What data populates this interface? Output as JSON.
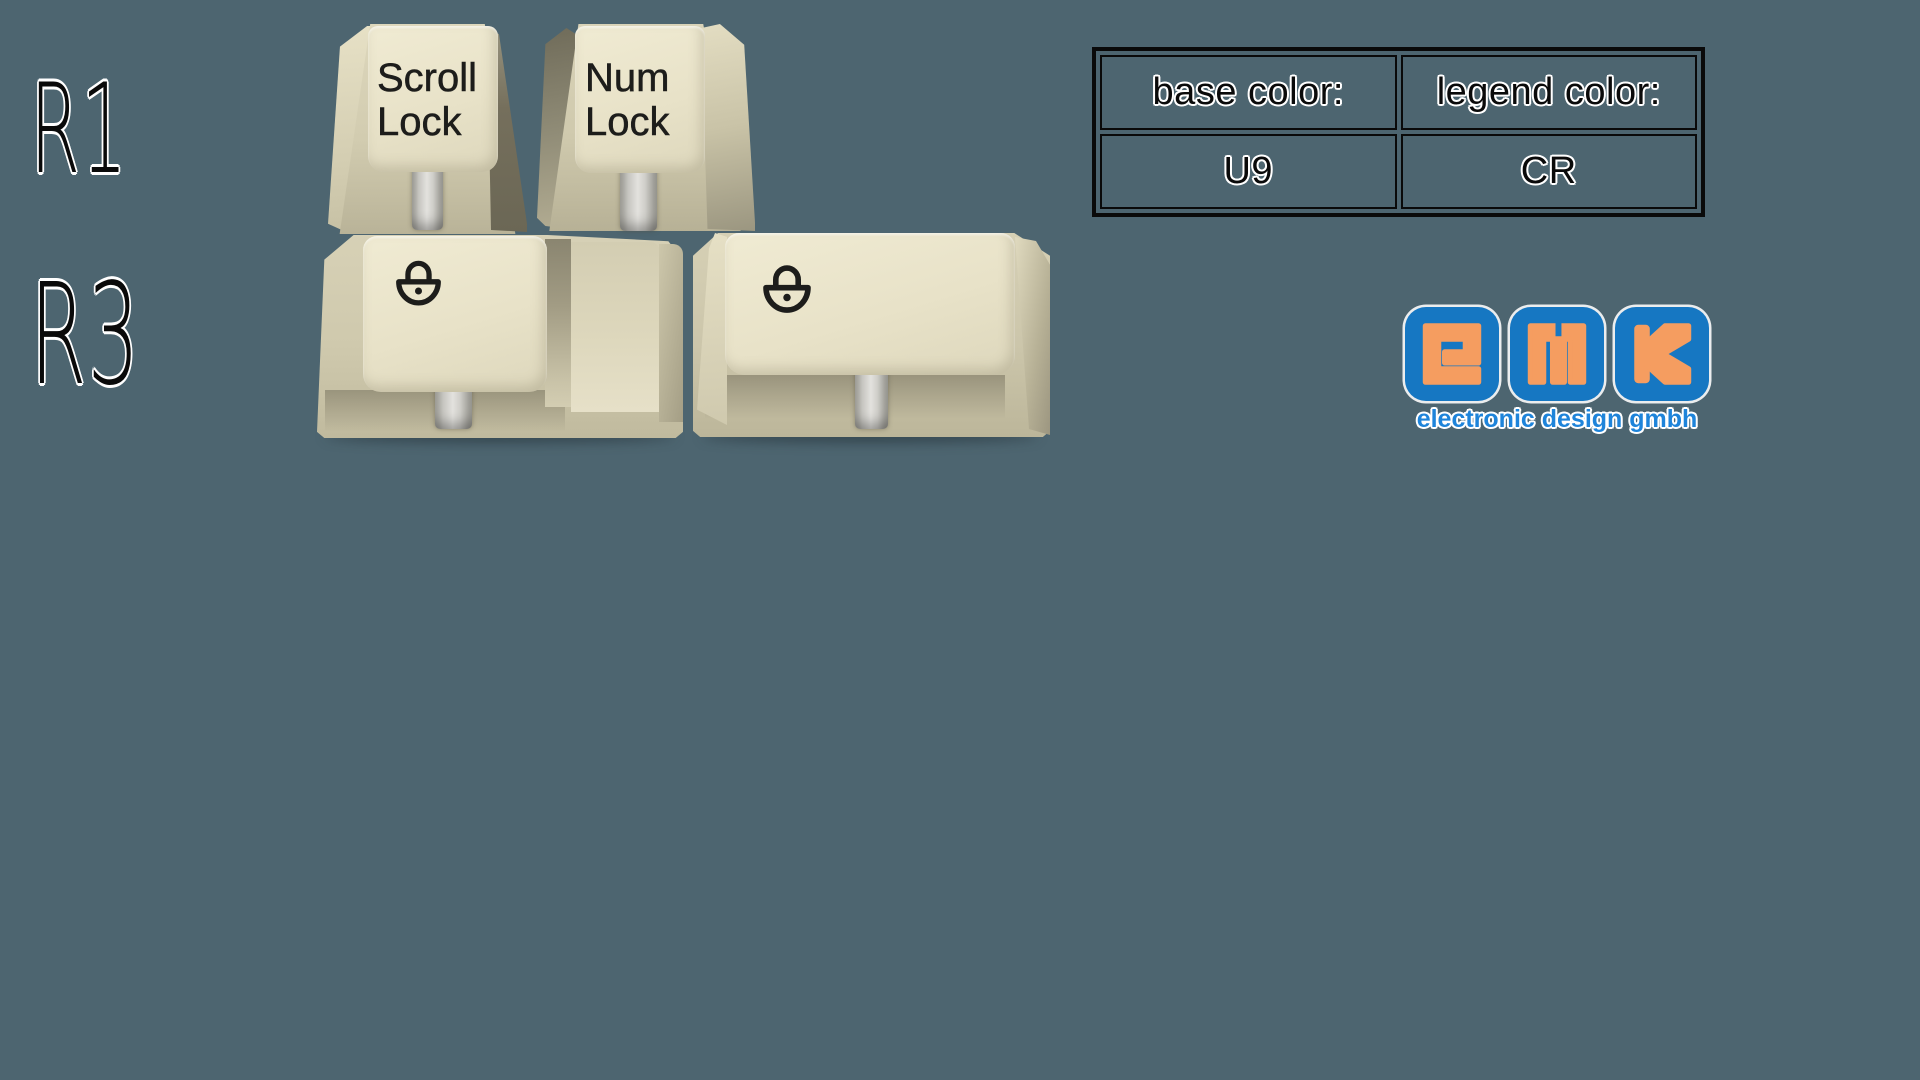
{
  "page": {
    "description": "GMK keycap set render: lock keys on R1 and R3 profiles with color spec table and GMK logo"
  },
  "row_labels": {
    "r1": "R1",
    "r3": "R3"
  },
  "keycaps": {
    "scroll_lock": {
      "profile": "R1",
      "line1": "Scroll",
      "line2": "Lock"
    },
    "num_lock": {
      "profile": "R1",
      "line1": "Num",
      "line2": "Lock"
    },
    "stepped_lock": {
      "profile": "R3",
      "legend_icon": "padlock-icon",
      "shape": "stepped"
    },
    "wide_lock": {
      "profile": "R3",
      "legend_icon": "padlock-icon",
      "shape": "wide"
    }
  },
  "spec_table": {
    "columns": [
      {
        "header": "base color:",
        "value": "U9"
      },
      {
        "header": "legend color:",
        "value": "CR"
      }
    ]
  },
  "logo": {
    "letters": [
      "G",
      "M",
      "K"
    ],
    "tagline": "electronic design gmbh"
  },
  "colors": {
    "background": "#4d6570",
    "legend": "#1d1d1b",
    "logo_blue": "#1677c2",
    "logo_orange": "#f59d60",
    "tagline_blue": "#1e84da",
    "table_border": "#0a0a0a",
    "keycap_base": "#e8e2c8"
  }
}
